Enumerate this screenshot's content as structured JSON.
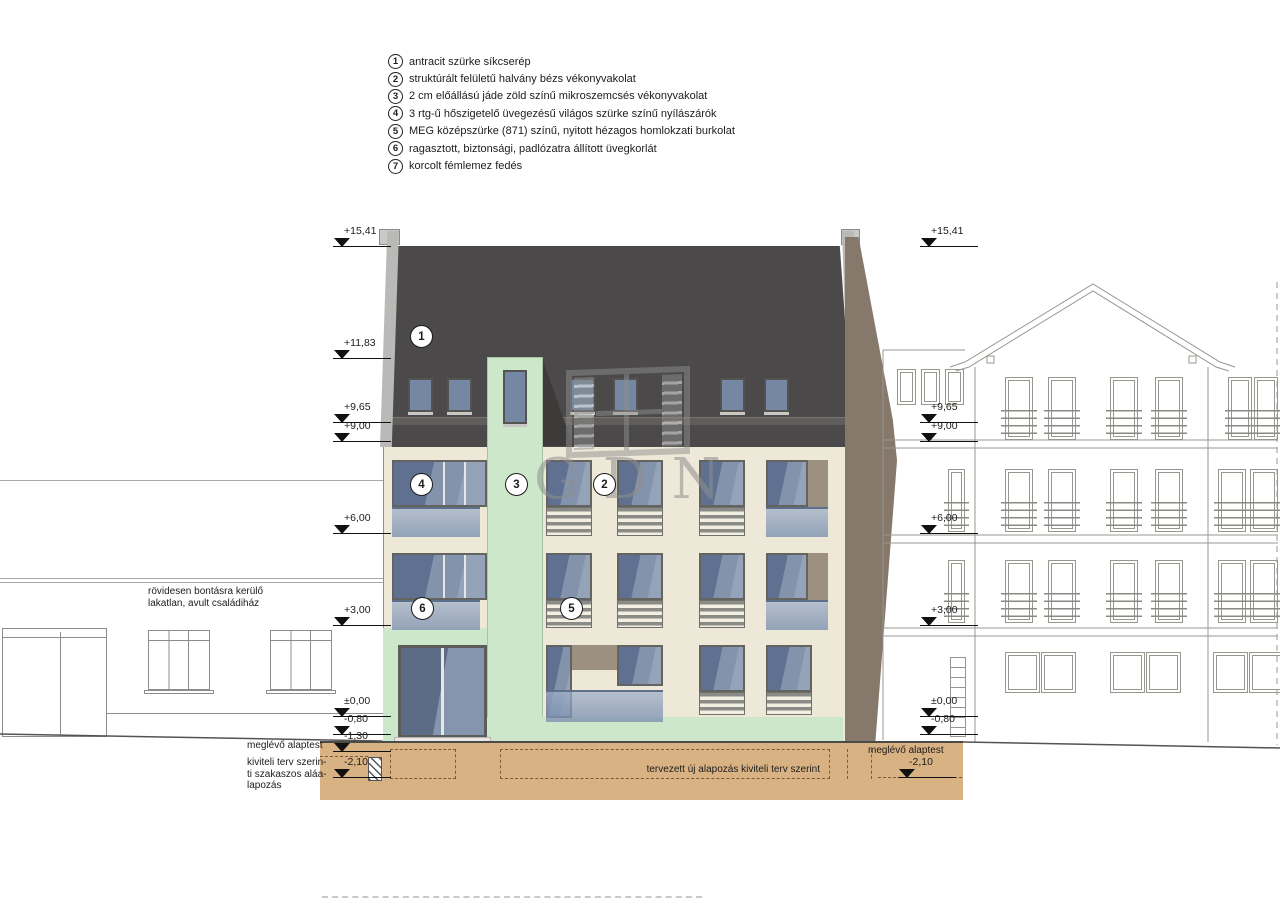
{
  "legend": {
    "items": [
      {
        "num": "1",
        "text": "antracit szürke síkcserép"
      },
      {
        "num": "2",
        "text": "struktúrált felületű halvány bézs vékonyvakolat"
      },
      {
        "num": "3",
        "text": "2 cm előállású jáde zöld színű mikroszemcsés vékonyvakolat"
      },
      {
        "num": "4",
        "text": "3 rtg-ű hőszigetelő üvegezésű világos szürke színű nyílászárók"
      },
      {
        "num": "5",
        "text": "MEG középszürke (871) színű, nyitott hézagos homlokzati burkolat"
      },
      {
        "num": "6",
        "text": "ragasztott, biztonsági, padlózatra állított üvegkorlát"
      },
      {
        "num": "7",
        "text": "korcolt fémlemez fedés"
      }
    ]
  },
  "elevation_markers": {
    "left": [
      {
        "label": "+15,41",
        "y": 247
      },
      {
        "label": "+11,83",
        "y": 359
      },
      {
        "label": "+9,65",
        "y": 423
      },
      {
        "label": "+9,00",
        "y": 442
      },
      {
        "label": "+6,00",
        "y": 534
      },
      {
        "label": "+3,00",
        "y": 626
      },
      {
        "label": "±0,00",
        "y": 717
      },
      {
        "label": "-0,80",
        "y": 735
      },
      {
        "label": "-1,30",
        "y": 752
      },
      {
        "label": "-2,10",
        "y": 778
      }
    ],
    "right": [
      {
        "label": "+15,41",
        "y": 247
      },
      {
        "label": "+9,65",
        "y": 423
      },
      {
        "label": "+9,00",
        "y": 442
      },
      {
        "label": "+6,00",
        "y": 534
      },
      {
        "label": "+3,00",
        "y": 626
      },
      {
        "label": "±0,00",
        "y": 717
      },
      {
        "label": "-0,80",
        "y": 735
      },
      {
        "label": "-2,10",
        "y": 778,
        "x": 898
      }
    ]
  },
  "callouts": [
    {
      "num": "1",
      "x": 420,
      "y": 335
    },
    {
      "num": "4",
      "x": 420,
      "y": 483
    },
    {
      "num": "3",
      "x": 515,
      "y": 483
    },
    {
      "num": "2",
      "x": 603,
      "y": 483
    },
    {
      "num": "6",
      "x": 421,
      "y": 607
    },
    {
      "num": "5",
      "x": 570,
      "y": 607
    }
  ],
  "annotations": {
    "demolition_note_line1": "rövidesen bontásra kerülő",
    "demolition_note_line2": "lakatlan, avult családiház",
    "existing_foundation_left": "meglévő alaptest",
    "underpinning_line1": "kiviteli terv szerin-",
    "underpinning_line2": "ti szakaszos aláa-",
    "underpinning_line3": "lapozás",
    "new_foundation_note": "tervezett új alapozás kiviteli terv szerint",
    "existing_foundation_right": "meglévő alaptest"
  },
  "watermark": {
    "text": "GDN"
  },
  "colors": {
    "roof": "#4b4949",
    "facade": "#eee8d8",
    "accent_green": "#cde7cb",
    "glass": "#7e8ea6",
    "glass_light": "#95a3b8",
    "louver_gray": "#8a8a86",
    "soil_tan": "#d9b284",
    "firewall_gray": "#b9b9b7",
    "neighbor_wall_brown": "#86786a",
    "outline_gray": "#97978f"
  }
}
